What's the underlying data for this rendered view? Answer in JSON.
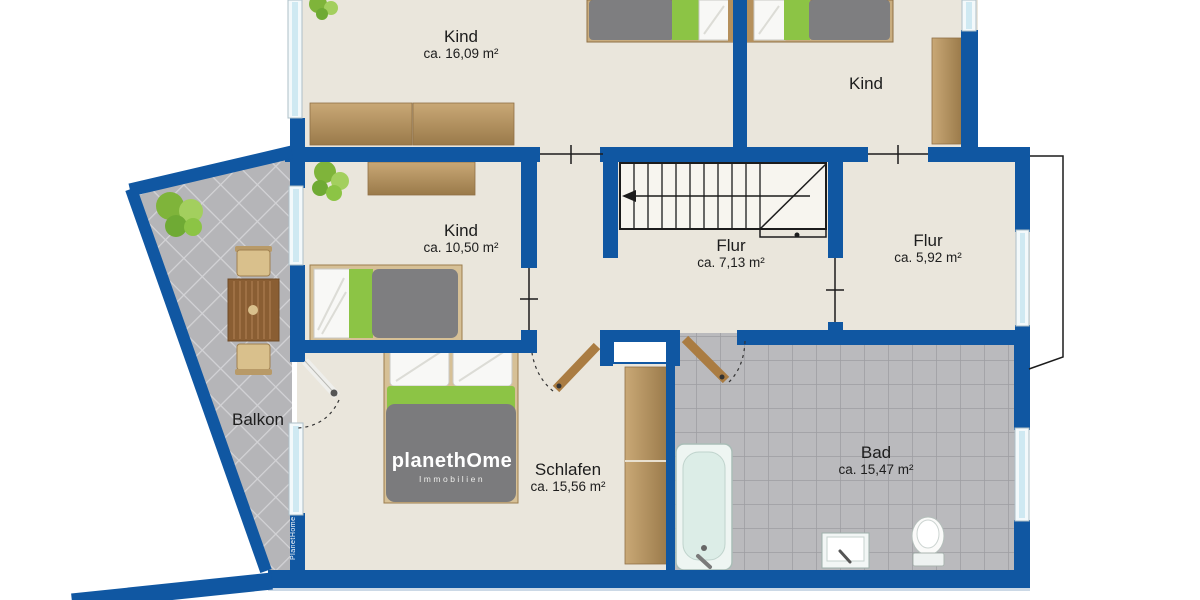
{
  "rooms": [
    {
      "label": "Kind",
      "area": "ca. 16,09 m²"
    },
    {
      "label": "Kind",
      "area": ""
    },
    {
      "label": "Kind",
      "area": "ca. 10,50 m²"
    },
    {
      "label": "Flur",
      "area": "ca. 7,13 m²"
    },
    {
      "label": "Flur",
      "area": "ca. 5,92 m²"
    },
    {
      "label": "Balkon",
      "area": ""
    },
    {
      "label": "Schlafen",
      "area": "ca. 15,56 m²"
    },
    {
      "label": "Bad",
      "area": "ca. 15,47 m²"
    }
  ],
  "branding": {
    "logo_main": "planethOme",
    "logo_sub": "Immobilien",
    "wall_text": "PlanetHome"
  },
  "colors": {
    "wall_blue": "#1057a2",
    "floor_cream": "#eae6dc",
    "tile_gray": "#b5b5b8",
    "accent_green": "#8cc445",
    "wood": "#b3905e"
  }
}
